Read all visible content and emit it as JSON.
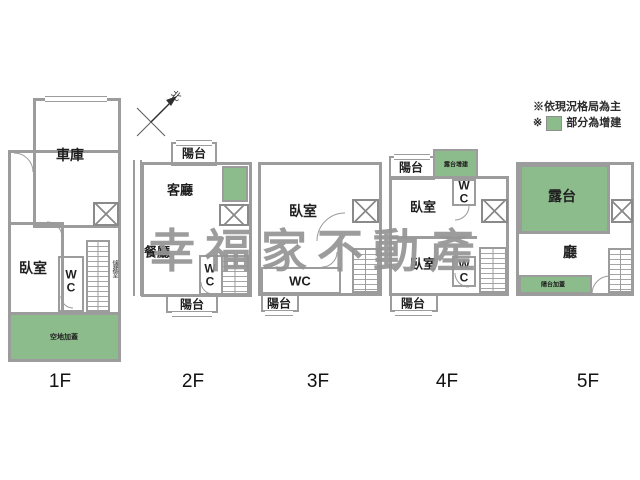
{
  "watermark": {
    "text": "幸福家不動產"
  },
  "legend": {
    "line1": "※依現況格局為主",
    "line2_mark": "※",
    "line2_text": "部分為增建"
  },
  "compass": {
    "north_label": "北"
  },
  "colors": {
    "wall_gray": "#9c9c9c",
    "addition_green": "#8cbb8c",
    "watermark_gray": "#949494"
  },
  "floors": {
    "f1": {
      "label": "1F",
      "garage": "車庫",
      "bedroom": "臥室",
      "wc": "WC",
      "storage": "儲藏室",
      "ground_addition": "空地加蓋"
    },
    "f2": {
      "label": "2F",
      "balcony_top": "陽台",
      "living_room": "客廳",
      "dining_room": "餐廳",
      "wc": "WC",
      "balcony_bottom": "陽台"
    },
    "f3": {
      "label": "3F",
      "bedroom": "臥室",
      "wc": "WC",
      "balcony_bottom": "陽台"
    },
    "f4": {
      "label": "4F",
      "balcony_top": "陽台",
      "terrace_addition": "露台增建",
      "bedroom_front": "臥室",
      "wc_front": "WC",
      "bedroom_back": "臥室",
      "wc_back": "WC",
      "balcony_bottom": "陽台"
    },
    "f5": {
      "label": "5F",
      "terrace": "露台",
      "hall": "廳",
      "balcony_addition": "陽台加蓋"
    }
  }
}
